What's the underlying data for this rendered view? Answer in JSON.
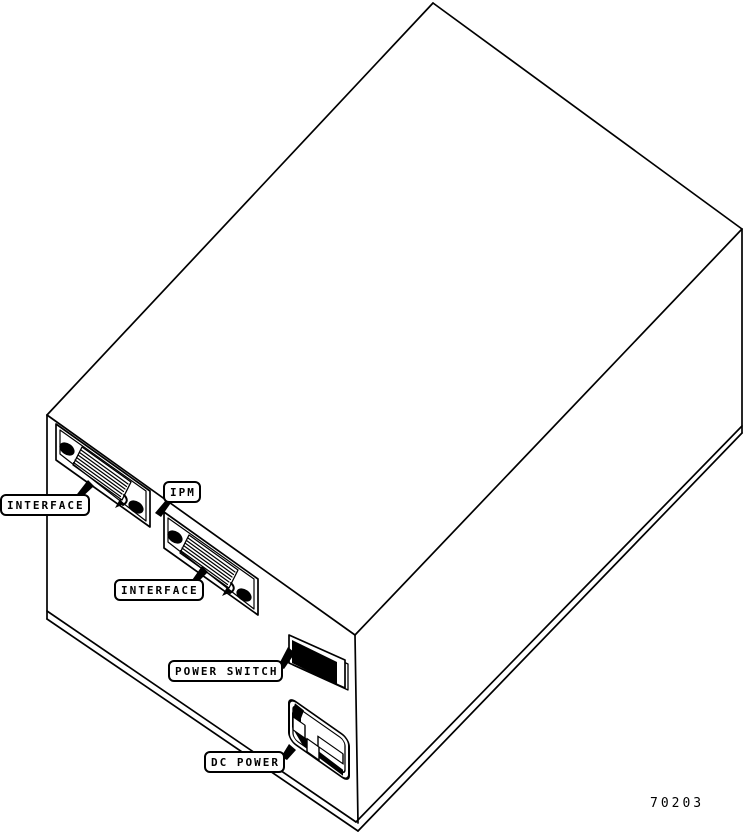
{
  "colors": {
    "line": "#000000",
    "background": "#ffffff"
  },
  "callouts": {
    "interface_top": "INTERFACE",
    "ipm": "IPM",
    "interface_bottom": "INTERFACE",
    "power_switch": "POWER SWITCH",
    "dc_power": "DC POWER"
  },
  "figure_number": "70203"
}
